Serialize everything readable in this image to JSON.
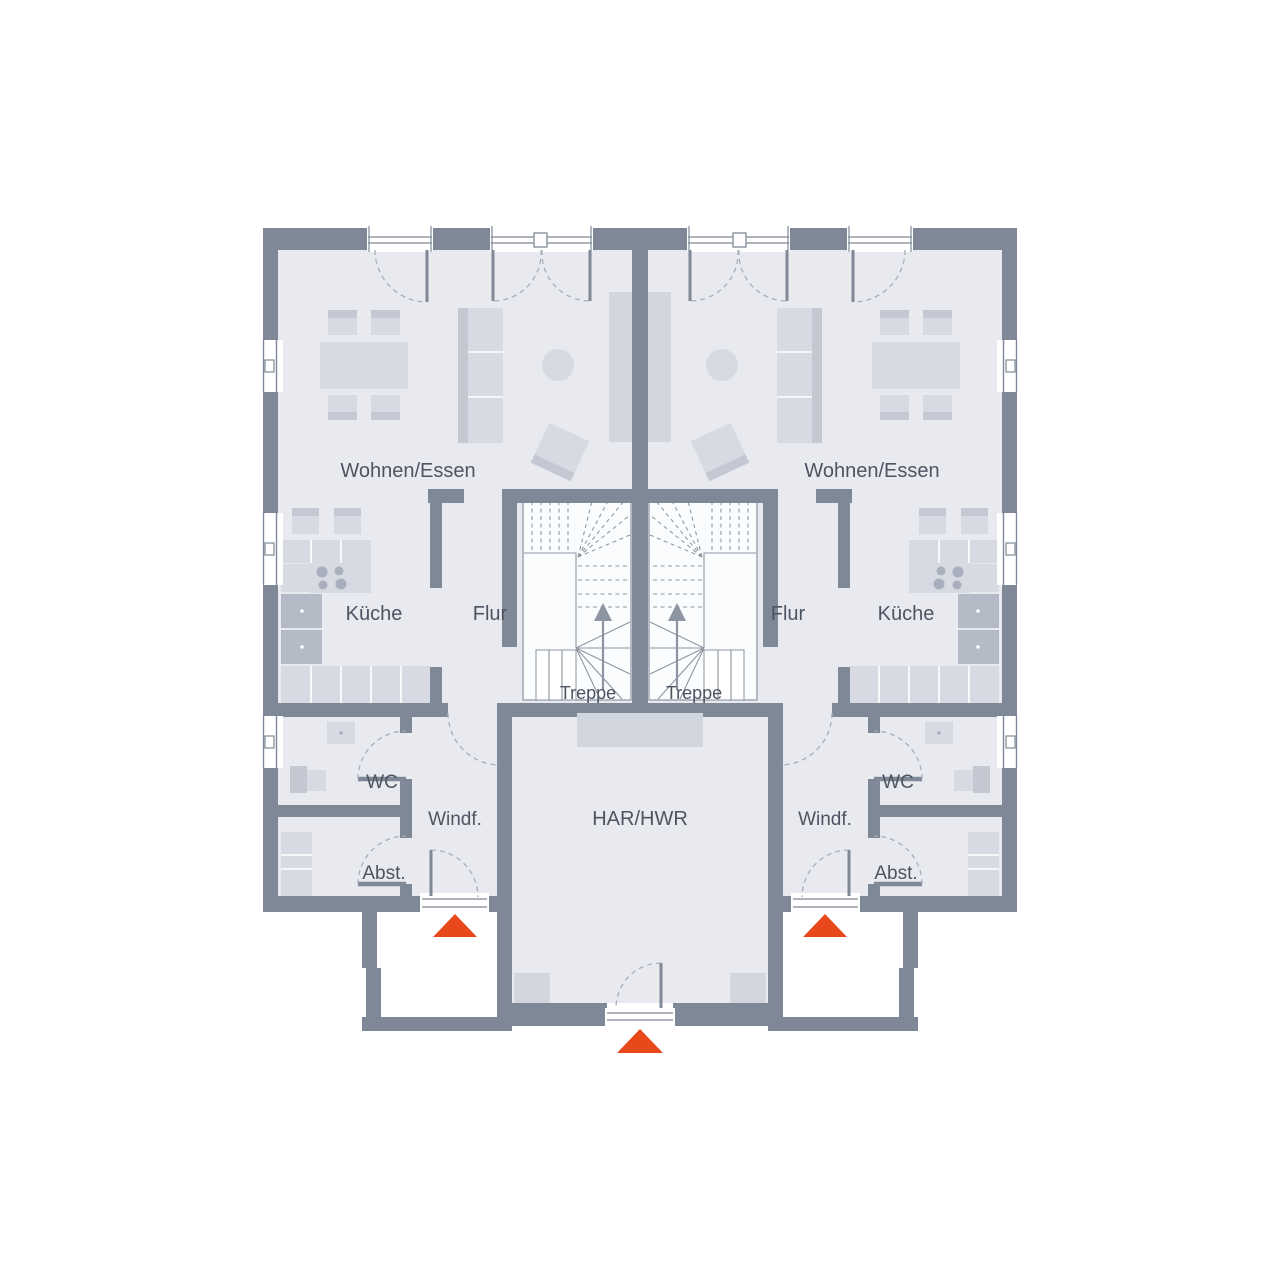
{
  "plan": {
    "type": "floor-plan-ground-floor",
    "units": [
      "left",
      "right"
    ],
    "labels": {
      "wohnen_left": "Wohnen/Essen",
      "wohnen_right": "Wohnen/Essen",
      "kueche_left": "Küche",
      "kueche_right": "Küche",
      "flur_left": "Flur",
      "flur_right": "Flur",
      "treppe_left": "Treppe",
      "treppe_right": "Treppe",
      "wc_left": "WC",
      "wc_right": "WC",
      "windf_left": "Windf.",
      "windf_right": "Windf.",
      "abst_left": "Abst.",
      "abst_right": "Abst.",
      "har_hwr": "HAR/HWR"
    },
    "markers": {
      "entrance_arrows": 3,
      "entrance_arrow_color": "#e8491b"
    },
    "colors": {
      "wall": "#7f8896",
      "room": "#e8eaf0",
      "furniture": "#d7dae2",
      "furniture_mid": "#c3c8d3",
      "furniture_dark": "#b4bac6",
      "burner": "#a9afbc",
      "mat": "#d2d6de",
      "dash_line": "#a7aeba",
      "stair_line": "#8d95a3",
      "label_text": "#4d5462",
      "entry": "#e8491b"
    }
  }
}
